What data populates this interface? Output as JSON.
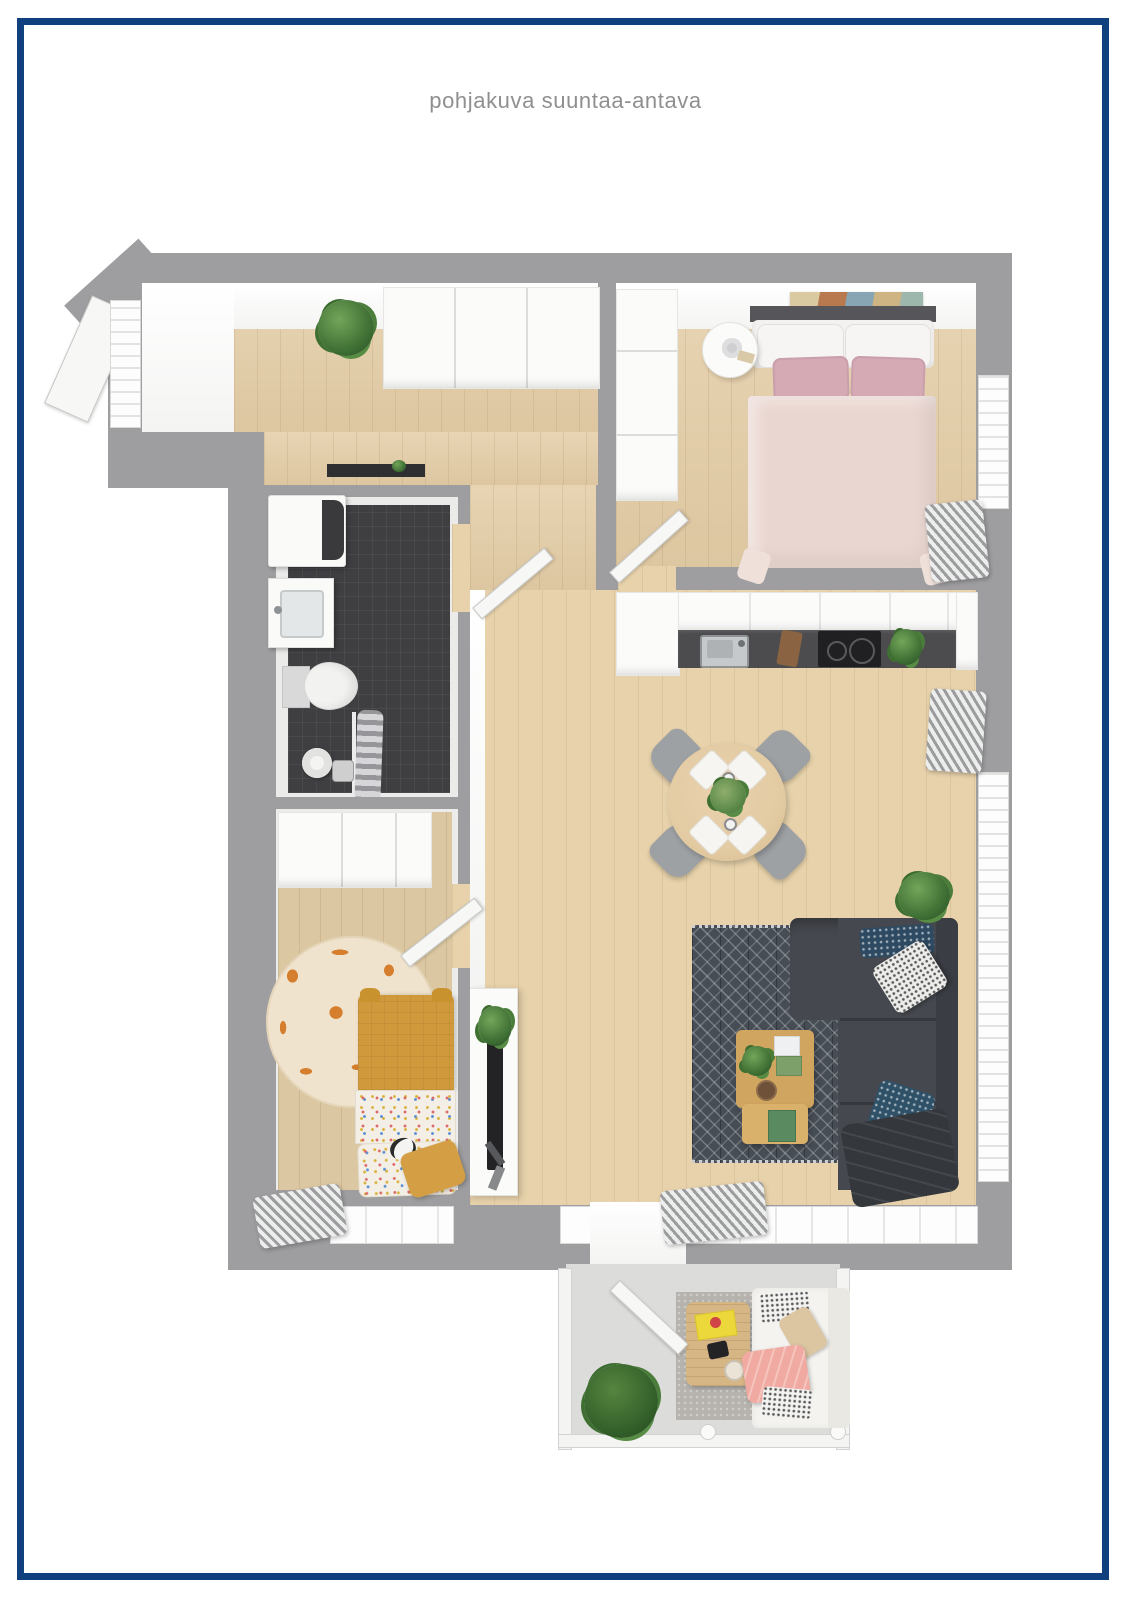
{
  "title": {
    "text": "pohjakuva suuntaa-antava",
    "color": "#8e8f90"
  },
  "frame": {
    "color": "#10407e",
    "thickness_px": 7
  },
  "palette": {
    "wall": "#9e9ea0",
    "wood_floor": "#e4cda6",
    "bathroom_floor": "#3f3f42",
    "cabinet_white": "#fbfbfa",
    "bed_duvet_blush": "#ead6d0",
    "pillow_pink": "#d5aab5",
    "kids_duvet_mustard": "#d0993c",
    "sofa_charcoal": "#45484e",
    "rug_dark": "#474d55",
    "table_wood": "#e3cba3",
    "balcony_blanket_pink": "#f0aaa2",
    "plant_green": "#3f7034",
    "giraffe_rug_spot": "#d57e2d",
    "counter_dark": "#4c4c4e"
  },
  "floorplan": {
    "type": "apartment-top-down-3d-render",
    "rooms": [
      {
        "id": "entry-hall",
        "items": [
          "entry-door",
          "wardrobe",
          "plant",
          "window"
        ]
      },
      {
        "id": "bedroom",
        "items": [
          "double-bed",
          "white-pillows",
          "pink-pillows",
          "wall-art",
          "round-nightstand",
          "table-lamp",
          "tall-wardrobe",
          "window",
          "radiator",
          "door"
        ]
      },
      {
        "id": "bathroom",
        "items": [
          "washing-machine",
          "laundry-shelf",
          "sink-vanity",
          "toilet",
          "shower-head",
          "shower-mixer",
          "shower-curtain",
          "door"
        ]
      },
      {
        "id": "kitchen",
        "items": [
          "tall-cabinet",
          "upper-cabinets",
          "counter",
          "sink",
          "cutting-board",
          "cooktop",
          "herb-plant"
        ]
      },
      {
        "id": "dining-area",
        "items": [
          "round-table",
          "chair",
          "chair",
          "chair",
          "chair",
          "place-settings",
          "centerpiece"
        ]
      },
      {
        "id": "living-room",
        "items": [
          "corner-sofa",
          "navy-cushion",
          "patterned-cushion",
          "teal-cushion",
          "throw-blanket",
          "geometric-rug",
          "coffee-table",
          "plant",
          "tv-bench",
          "tv",
          "bench-plant",
          "window-right",
          "window-bottom",
          "radiator-right",
          "radiator-bottom"
        ]
      },
      {
        "id": "kids-room",
        "items": [
          "wardrobe",
          "mustard-bed",
          "patterned-sheets",
          "mustard-pillow",
          "panda-plush",
          "giraffe-rug",
          "radiator",
          "window",
          "door"
        ]
      },
      {
        "id": "balcony",
        "items": [
          "glass-railing",
          "outdoor-sofa",
          "bw-cushions",
          "beige-cushion",
          "pink-blanket",
          "coffee-table",
          "yellow-book",
          "bowl",
          "rug",
          "plant",
          "door"
        ]
      }
    ]
  }
}
